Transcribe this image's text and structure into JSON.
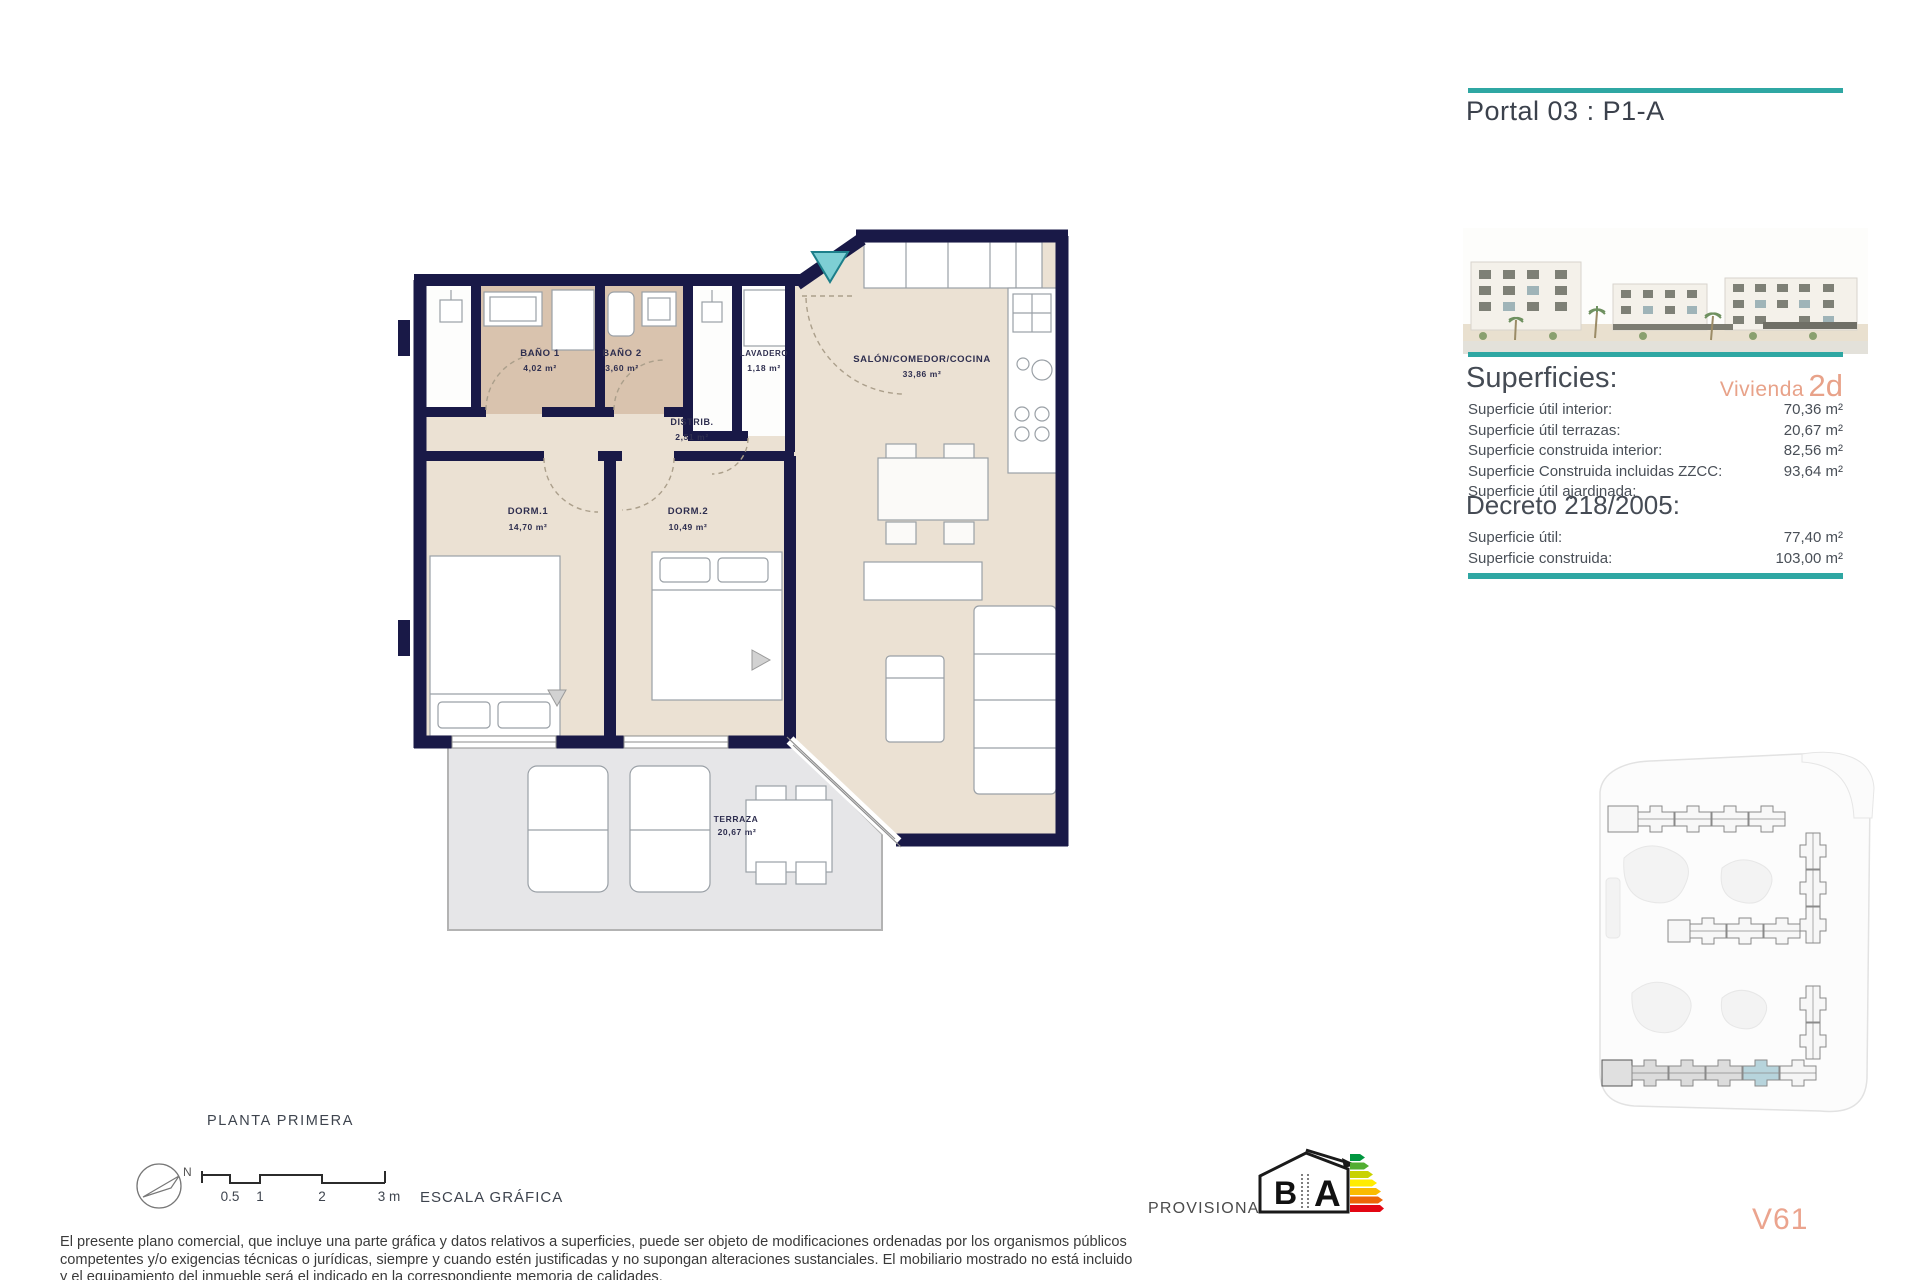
{
  "header": {
    "title": "Portal 03 : P1-A"
  },
  "superficies": {
    "heading": "Superficies:",
    "vivienda_label": "Vivienda",
    "vivienda_value": "2d",
    "rows": [
      {
        "label": "Superficie útil interior:",
        "value": "70,36 m²"
      },
      {
        "label": "Superficie útil terrazas:",
        "value": "20,67 m²"
      },
      {
        "label": "Superficie construida interior:",
        "value": "82,56 m²"
      },
      {
        "label": "Superficie Construida incluidas ZZCC:",
        "value": "93,64 m²"
      },
      {
        "label": "Superficie útil ajardinada:",
        "value": ""
      }
    ]
  },
  "decreto": {
    "heading": "Decreto 218/2005:",
    "rows": [
      {
        "label": "Superficie útil:",
        "value": "77,40 m²"
      },
      {
        "label": "Superficie construida:",
        "value": "103,00 m²"
      }
    ]
  },
  "plan": {
    "rooms": [
      {
        "name": "BAÑO 1",
        "area": "4,02 m²"
      },
      {
        "name": "BAÑO 2",
        "area": "3,60 m²"
      },
      {
        "name": "LAVADERO",
        "area": "1,18 m²"
      },
      {
        "name": "SALÓN/COMEDOR/COCINA",
        "area": "33,86 m²"
      },
      {
        "name": "DISTRIB.",
        "area": "2,51 m²"
      },
      {
        "name": "DORM.1",
        "area": "14,70 m²"
      },
      {
        "name": "DORM.2",
        "area": "10,49 m²"
      },
      {
        "name": "TERRAZA",
        "area": "20,67 m²"
      }
    ]
  },
  "footer": {
    "floor_label": "PLANTA PRIMERA",
    "north_label": "N",
    "scale_ticks": [
      "0.5",
      "1",
      "2",
      "3 m"
    ],
    "scale_label": "ESCALA GRÁFICA",
    "provisional_label": "PROVISIONAL",
    "energy_b": "B",
    "energy_a": "A",
    "unit_code": "V61",
    "disclaimer_lines": [
      "El presente plano comercial, que incluye una parte gráfica y datos relativos a superficies, puede ser objeto de modificaciones ordenadas por los organismos públicos",
      "competentes y/o exigencias técnicas o jurídicas, siempre y cuando estén justificadas y no supongan alteraciones sustanciales. El mobiliario mostrado no está incluido",
      "y el equipamiento del inmueble será el indicado en la correspondiente memoria de calidades."
    ]
  },
  "colors": {
    "accent_teal": "#2FA7A3",
    "accent_salmon": "#E9A38A",
    "wall_navy": "#191947",
    "floor_beige": "#EBE1D3",
    "bath_tan": "#D9C3AE",
    "terrace_gray": "#E6E6E8",
    "entrance_marker_teal": "#7ECFD4",
    "siteplan_highlight": "#B7D4DC",
    "energy_scale": [
      "#00963F",
      "#52AE32",
      "#C8D200",
      "#FFEC00",
      "#FABA00",
      "#EC6607",
      "#E30613"
    ]
  }
}
